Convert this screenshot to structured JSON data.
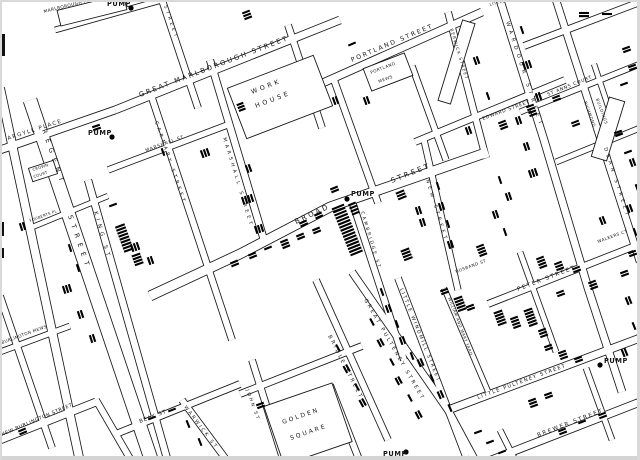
{
  "map": {
    "title": "Snow cholera map of Soho (Broad Street pump area)",
    "paper_color": "#ffffff",
    "ink_color": "#161616",
    "bar_color": "#000000",
    "edge_color": "#cccccc",
    "street_labels": [
      {
        "text": "GREAT MARLBOROUGH STREET",
        "x": 140,
        "y": 97,
        "rot": -21,
        "size": 6.8,
        "sp": 2.2
      },
      {
        "text": "PORTLAND STREET",
        "x": 352,
        "y": 62,
        "rot": -23,
        "size": 6.2,
        "sp": 2
      },
      {
        "text": "ARGYLL PLACE",
        "x": 8,
        "y": 140,
        "rot": -18,
        "size": 5.4,
        "sp": 1.5
      },
      {
        "text": "BROAD",
        "x": 296,
        "y": 224,
        "rot": -25,
        "size": 7,
        "sp": 2.6
      },
      {
        "text": "STREET",
        "x": 392,
        "y": 183,
        "rot": -22,
        "size": 7,
        "sp": 2.6
      },
      {
        "text": "EDWARD STREET",
        "x": 483,
        "y": 120,
        "rot": -20,
        "size": 4.6,
        "sp": 0.8
      },
      {
        "text": "PETER STREET",
        "x": 518,
        "y": 291,
        "rot": -21,
        "size": 5.6,
        "sp": 1.8
      },
      {
        "text": "LITTLE PULTENEY STREET",
        "x": 478,
        "y": 399,
        "rot": -20,
        "size": 5,
        "sp": 1.4
      },
      {
        "text": "BREWER STREET",
        "x": 538,
        "y": 437,
        "rot": -21,
        "size": 5.6,
        "sp": 1.8
      },
      {
        "text": "NEW BURLINGTON STREET",
        "x": 2,
        "y": 436,
        "rot": -23,
        "size": 4.8,
        "sp": 0.6
      },
      {
        "text": "BURLINGTON MEWS",
        "x": 2,
        "y": 344,
        "rot": -20,
        "size": 4.2,
        "sp": 0.4
      },
      {
        "text": "BEAK ST",
        "x": 140,
        "y": 423,
        "rot": -21,
        "size": 5.2,
        "sp": 1
      },
      {
        "text": "MARSHALL ST",
        "x": 146,
        "y": 152,
        "rot": -20,
        "size": 4.6,
        "sp": 0.8
      },
      {
        "text": "FOUBERTS PL",
        "x": 30,
        "y": 222,
        "rot": -20,
        "size": 3.8,
        "sp": 0.3
      },
      {
        "text": "ST ANNS COURT",
        "x": 548,
        "y": 96,
        "rot": -22,
        "size": 4.6,
        "sp": 0.8
      },
      {
        "text": "WALKERS CT",
        "x": 598,
        "y": 243,
        "rot": -20,
        "size": 4.2,
        "sp": 0.5
      },
      {
        "text": "HUSBAND ST",
        "x": 456,
        "y": 273,
        "rot": -20,
        "size": 4.2,
        "sp": 0.5
      },
      {
        "text": "LITTLE",
        "x": 490,
        "y": 6,
        "rot": -15,
        "size": 4,
        "sp": 0.5
      },
      {
        "text": "REGENT",
        "x": 42,
        "y": 130,
        "rot": 71,
        "size": 6.6,
        "sp": 5.5
      },
      {
        "text": "STREET",
        "x": 68,
        "y": 216,
        "rot": 71,
        "size": 6.6,
        "sp": 5.5
      },
      {
        "text": "KING ST",
        "x": 94,
        "y": 212,
        "rot": 74,
        "size": 5.4,
        "sp": 4
      },
      {
        "text": "CARNABY STREET",
        "x": 155,
        "y": 122,
        "rot": 71,
        "size": 4.8,
        "sp": 3.2
      },
      {
        "text": "MARSHALL STREET",
        "x": 223,
        "y": 138,
        "rot": 73,
        "size": 4.8,
        "sp": 3.2
      },
      {
        "text": "STREET",
        "x": 164,
        "y": 6,
        "rot": 71,
        "size": 4.6,
        "sp": 3
      },
      {
        "text": "WARDOUR STREET",
        "x": 506,
        "y": 22,
        "rot": 72,
        "size": 5.2,
        "sp": 4.5
      },
      {
        "text": "DEAN STREET",
        "x": 604,
        "y": 148,
        "rot": 72,
        "size": 5,
        "sp": 3.6
      },
      {
        "text": "NEW STREET",
        "x": 426,
        "y": 180,
        "rot": 73,
        "size": 4.8,
        "sp": 3.4
      },
      {
        "text": "CAMBRIDGE ST",
        "x": 361,
        "y": 212,
        "rot": 73,
        "size": 4.4,
        "sp": 2.2
      },
      {
        "text": "GREAT PULTENEY STREET",
        "x": 364,
        "y": 300,
        "rot": 60,
        "size": 5.2,
        "sp": 2.4
      },
      {
        "text": "BRIDLE STREET",
        "x": 328,
        "y": 336,
        "rot": 63,
        "size": 5.2,
        "sp": 2.4
      },
      {
        "text": "LITTLE WINDMILL STREET",
        "x": 400,
        "y": 289,
        "rot": 68,
        "size": 4.8,
        "sp": 1.8
      },
      {
        "text": "WILLIAM AND MARY YARD",
        "x": 448,
        "y": 298,
        "rot": 69,
        "size": 4,
        "sp": 0.5
      },
      {
        "text": "WARWICK ST",
        "x": 184,
        "y": 407,
        "rot": 53,
        "size": 4.8,
        "sp": 2.2
      },
      {
        "text": "JOHN ST",
        "x": 246,
        "y": 390,
        "rot": 70,
        "size": 4.6,
        "sp": 2
      }
    ],
    "building_labels": [
      {
        "text": "WORK",
        "x": 252,
        "y": 94,
        "rot": -21,
        "size": 6.4,
        "sp": 3
      },
      {
        "text": "HOUSE",
        "x": 256,
        "y": 108,
        "rot": -21,
        "size": 6.4,
        "sp": 3
      },
      {
        "text": "GOLDEN",
        "x": 283,
        "y": 424,
        "rot": -19,
        "size": 6,
        "sp": 2.2
      },
      {
        "text": "SQUARE",
        "x": 291,
        "y": 440,
        "rot": -19,
        "size": 6,
        "sp": 2.2
      },
      {
        "text": "PORTLAND",
        "x": 371,
        "y": 74,
        "rot": -21,
        "size": 4.2,
        "sp": 0.5
      },
      {
        "text": "MEWS",
        "x": 379,
        "y": 83,
        "rot": -21,
        "size": 4.2,
        "sp": 0.5
      },
      {
        "text": "MARLBOROUGH MEWS",
        "x": 44,
        "y": 13,
        "rot": -14,
        "size": 4.4,
        "sp": 0.4
      },
      {
        "text": "BERWICK STREET",
        "x": 450,
        "y": 29,
        "rot": 73,
        "size": 4.2,
        "sp": 1.2
      },
      {
        "text": "RICHMOND",
        "x": 584,
        "y": 102,
        "rot": 70,
        "size": 4,
        "sp": 0.6
      },
      {
        "text": "BUILDINGS",
        "x": 596,
        "y": 99,
        "rot": 70,
        "size": 4,
        "sp": 0.6
      },
      {
        "text": "CROWN",
        "x": 33,
        "y": 171,
        "rot": -18,
        "size": 3.8,
        "sp": 0.3
      },
      {
        "text": "COURT",
        "x": 34,
        "y": 178,
        "rot": -18,
        "size": 3.8,
        "sp": 0.3
      }
    ],
    "pumps": [
      {
        "label": "PUMP",
        "label_x": 107,
        "label_y": 6,
        "dot_x": 131,
        "dot_y": 8
      },
      {
        "label": "PUMP",
        "label_x": 88,
        "label_y": 135,
        "dot_x": 112,
        "dot_y": 137
      },
      {
        "label": "PUMP",
        "label_x": 351,
        "label_y": 196,
        "dot_x": 347,
        "dot_y": 199
      },
      {
        "label": "PUMP",
        "label_x": 383,
        "label_y": 456,
        "dot_x": 406,
        "dot_y": 452
      },
      {
        "label": "PUMP",
        "label_x": 604,
        "label_y": 363,
        "dot_x": 600,
        "dot_y": 365
      }
    ],
    "cluster_format": "[x, y, bar_angle_deg, bar_count, step(optional), bar_length(optional)] — each bar = one cholera death, bars stack perpendicular to street",
    "death_bar_clusters": [
      [
        246,
        12,
        -21,
        3
      ],
      [
        96,
        126,
        -19,
        2
      ],
      [
        352,
        44,
        -23,
        1
      ],
      [
        368,
        100,
        70,
        2
      ],
      [
        337,
        100,
        70,
        2
      ],
      [
        478,
        60,
        70,
        2
      ],
      [
        488,
        96,
        70,
        1
      ],
      [
        470,
        130,
        70,
        2
      ],
      [
        530,
        64,
        71,
        3
      ],
      [
        540,
        96,
        71,
        2
      ],
      [
        522,
        30,
        71,
        1
      ],
      [
        520,
        120,
        71,
        2
      ],
      [
        528,
        146,
        71,
        2
      ],
      [
        536,
        172,
        71,
        3
      ],
      [
        584,
        13,
        0,
        2,
        3.1,
        10
      ],
      [
        607,
        14,
        0,
        1,
        3.1,
        10
      ],
      [
        626,
        48,
        -20,
        2
      ],
      [
        632,
        66,
        -20,
        2
      ],
      [
        624,
        84,
        -20,
        1
      ],
      [
        530,
        106,
        -21,
        4
      ],
      [
        556,
        97,
        -21,
        2
      ],
      [
        502,
        122,
        -21,
        3
      ],
      [
        575,
        122,
        -21,
        2
      ],
      [
        618,
        132,
        -20,
        2
      ],
      [
        628,
        152,
        -20,
        1
      ],
      [
        240,
        104,
        -21,
        3,
        3.1,
        7
      ],
      [
        163,
        152,
        70,
        1
      ],
      [
        208,
        152,
        70,
        3
      ],
      [
        250,
        168,
        70,
        2
      ],
      [
        113,
        205,
        -20,
        1
      ],
      [
        120,
        226,
        -20,
        9,
        3.2,
        10
      ],
      [
        136,
        255,
        -20,
        4,
        3.1,
        9
      ],
      [
        24,
        226,
        72,
        2
      ],
      [
        70,
        248,
        72,
        1
      ],
      [
        78,
        268,
        72,
        1
      ],
      [
        252,
        198,
        72,
        4
      ],
      [
        262,
        228,
        72,
        3
      ],
      [
        138,
        246,
        71,
        3
      ],
      [
        152,
        260,
        71,
        2
      ],
      [
        70,
        288,
        72,
        3
      ],
      [
        82,
        314,
        72,
        2
      ],
      [
        94,
        338,
        72,
        2
      ],
      [
        234,
        262,
        -22,
        2
      ],
      [
        252,
        254,
        -22,
        2
      ],
      [
        268,
        248,
        -22,
        1
      ],
      [
        284,
        241,
        -22,
        3
      ],
      [
        300,
        235,
        -22,
        2
      ],
      [
        316,
        229,
        -22,
        2
      ],
      [
        334,
        188,
        -22,
        2
      ],
      [
        338,
        207,
        -22,
        16,
        3.3,
        13
      ],
      [
        352,
        204,
        -22,
        4,
        3.3,
        8
      ],
      [
        318,
        214,
        -24,
        2
      ],
      [
        303,
        222,
        -24,
        2
      ],
      [
        400,
        192,
        -22,
        3,
        3.1,
        9
      ],
      [
        420,
        210,
        72,
        2
      ],
      [
        424,
        222,
        72,
        2
      ],
      [
        405,
        250,
        -21,
        4,
        3.1,
        9
      ],
      [
        438,
        186,
        72,
        1
      ],
      [
        443,
        206,
        72,
        2
      ],
      [
        448,
        224,
        72,
        1
      ],
      [
        452,
        244,
        72,
        2
      ],
      [
        480,
        246,
        -21,
        4
      ],
      [
        500,
        180,
        71,
        1
      ],
      [
        510,
        196,
        71,
        2
      ],
      [
        497,
        214,
        71,
        2
      ],
      [
        505,
        232,
        71,
        1
      ],
      [
        540,
        258,
        -21,
        4
      ],
      [
        558,
        263,
        -21,
        3
      ],
      [
        576,
        268,
        -21,
        2
      ],
      [
        592,
        282,
        -21,
        3
      ],
      [
        560,
        292,
        -21,
        2
      ],
      [
        604,
        220,
        68,
        2
      ],
      [
        632,
        252,
        -20,
        2
      ],
      [
        624,
        272,
        -20,
        2
      ],
      [
        634,
        162,
        70,
        2
      ],
      [
        637,
        188,
        70,
        1
      ],
      [
        631,
        208,
        70,
        2
      ],
      [
        635,
        232,
        70,
        1
      ],
      [
        630,
        300,
        68,
        2
      ],
      [
        634,
        326,
        68,
        1
      ],
      [
        626,
        352,
        68,
        2
      ],
      [
        498,
        312,
        -20,
        5,
        3.1,
        9
      ],
      [
        514,
        318,
        -20,
        4
      ],
      [
        528,
        310,
        -20,
        6,
        3.1,
        9
      ],
      [
        542,
        330,
        -20,
        3
      ],
      [
        458,
        298,
        -20,
        5,
        3.1,
        9
      ],
      [
        444,
        290,
        -20,
        2
      ],
      [
        470,
        306,
        -20,
        2
      ],
      [
        382,
        292,
        70,
        1
      ],
      [
        390,
        308,
        70,
        2
      ],
      [
        397,
        324,
        70,
        1
      ],
      [
        404,
        340,
        70,
        2
      ],
      [
        412,
        356,
        70,
        1
      ],
      [
        422,
        362,
        66,
        2
      ],
      [
        432,
        378,
        66,
        1
      ],
      [
        442,
        394,
        66,
        2
      ],
      [
        450,
        408,
        66,
        1
      ],
      [
        372,
        322,
        62,
        1
      ],
      [
        382,
        342,
        62,
        2
      ],
      [
        392,
        362,
        62,
        1
      ],
      [
        400,
        380,
        62,
        2
      ],
      [
        410,
        398,
        62,
        1
      ],
      [
        420,
        414,
        62,
        2
      ],
      [
        338,
        348,
        61,
        1
      ],
      [
        348,
        368,
        61,
        2
      ],
      [
        357,
        387,
        61,
        1
      ],
      [
        364,
        402,
        61,
        2
      ],
      [
        548,
        346,
        -20,
        2
      ],
      [
        562,
        352,
        -20,
        3
      ],
      [
        578,
        358,
        -20,
        2
      ],
      [
        532,
        400,
        -20,
        3
      ],
      [
        548,
        394,
        -20,
        2
      ],
      [
        562,
        430,
        -21,
        2
      ],
      [
        582,
        422,
        -21,
        1
      ],
      [
        602,
        414,
        -21,
        2
      ],
      [
        502,
        452,
        -21,
        1
      ],
      [
        188,
        424,
        68,
        1
      ],
      [
        200,
        442,
        68,
        1
      ],
      [
        152,
        418,
        -21,
        1
      ],
      [
        172,
        410,
        -21,
        1
      ],
      [
        22,
        430,
        -23,
        2
      ],
      [
        478,
        432,
        -20,
        1
      ],
      [
        490,
        442,
        -20,
        1
      ],
      [
        260,
        404,
        -20,
        2
      ]
    ]
  }
}
